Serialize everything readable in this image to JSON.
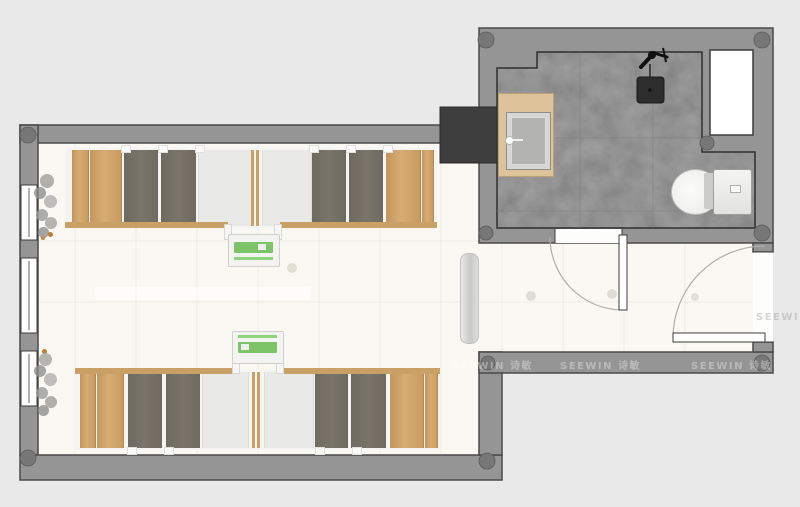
{
  "watermark": {
    "text": "SEEWIN 诗敏",
    "wall_instances": 3,
    "faint_floor_instances": 1
  },
  "colors": {
    "background": "#e9e9e9",
    "wall": "#959595",
    "wall_outline": "#4a4a4a",
    "room_floor": "#faf8f2",
    "bathroom_floor": "#a9a9a9",
    "wood_panel": "#cda168",
    "bed_panel": "#746e64",
    "desk_green": "#7dc468",
    "sink_counter": "#dcc39a",
    "column": "#777777",
    "shaft_box": "#3e3e3e",
    "door_leaf": "#ffffff"
  },
  "icons": [
    "window-icon",
    "column-icon",
    "plant-icon",
    "door-swing-icon",
    "radiator-icon",
    "sink-icon",
    "faucet-icon",
    "shower-head-icon",
    "shower-mixer-icon",
    "toilet-icon",
    "bed-panel",
    "wardrobe-panel",
    "study-desk",
    "shaft-icon",
    "window-shaft-icon"
  ]
}
